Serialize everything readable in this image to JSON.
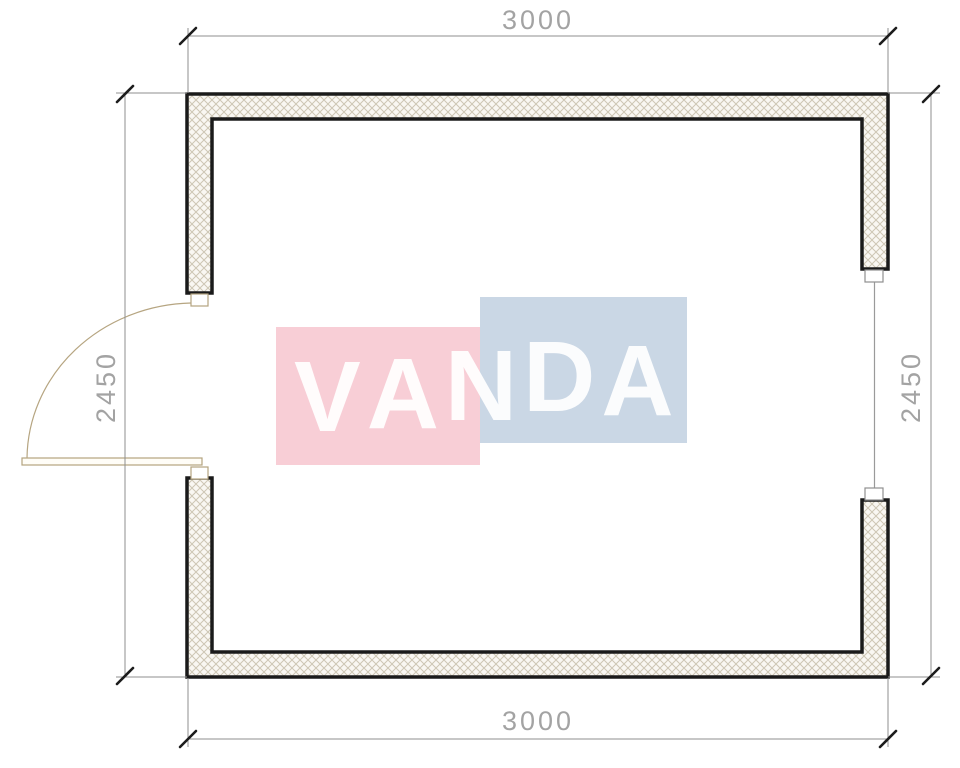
{
  "dimensions": {
    "width_top": "3000",
    "width_bottom": "3000",
    "height_left": "2450",
    "height_right": "2450"
  },
  "watermark": {
    "text": "VANDA",
    "letters": [
      "V",
      "A",
      "N",
      "D",
      "A"
    ],
    "pink_color": "#f8ced6",
    "blue_color": "#cad7e5",
    "text_color": "#ffffff"
  },
  "drawing": {
    "wall_outline_color": "#1a1a1a",
    "wall_fill_color": "#f9f7f2",
    "wall_hatch_line_color": "#cdc6b4",
    "dimension_line_color": "#8f8f8f",
    "dimension_text_color": "#a3a3a3",
    "tick_color": "#1c1c1c",
    "door_color": "#b3a37f",
    "window_color": "#8f8f8f"
  }
}
